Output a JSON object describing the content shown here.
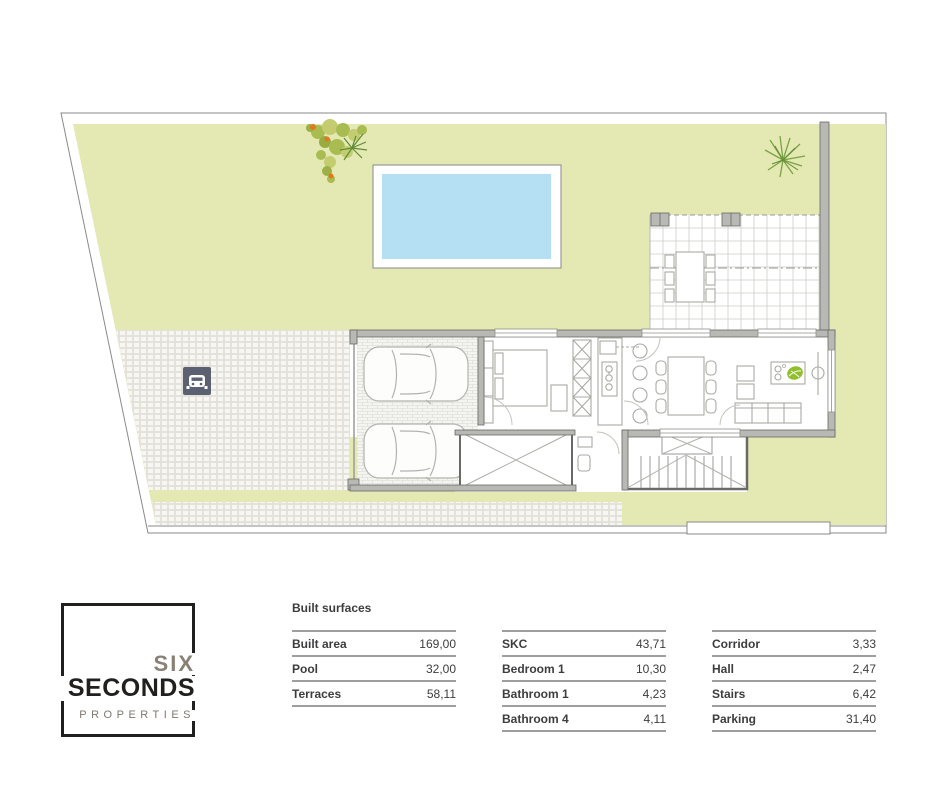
{
  "colors": {
    "garden": "#e4e8b2",
    "pool": "#b5dff2",
    "paving": "#f2f2ef",
    "wall": "#b8b8b4",
    "wall_dark": "#696965",
    "boundary": "#8a8a88",
    "grid": "#cdcdc8",
    "furniture": "#a9a9a4",
    "sign": "#5b6170",
    "island_green": "#8fbf2a",
    "plant": "#a8bc52",
    "plant_alt": "#c3cd6f",
    "plant_dark": "#6f9440",
    "accent_orange": "#e0791f",
    "text": "#3d3d3f",
    "rule": "#9e9e9c",
    "logo_black": "#22201e",
    "logo_gray": "#8a8176",
    "logo_light": "#7d786f"
  },
  "logo": {
    "word_top": "SIX",
    "word_main": "SECONDS",
    "word_sub": "PROPERTIES"
  },
  "surfaces": {
    "heading": "Built surfaces",
    "groups": [
      {
        "rows": [
          {
            "label": "Built area",
            "value": "169,00"
          },
          {
            "label": "Pool",
            "value": "32,00"
          },
          {
            "label": "Terraces",
            "value": "58,11"
          }
        ]
      },
      {
        "rows": [
          {
            "label": "SKC",
            "value": "43,71"
          },
          {
            "label": "Bedroom 1",
            "value": "10,30"
          },
          {
            "label": "Bathroom 1",
            "value": "4,23"
          },
          {
            "label": "Bathroom 4",
            "value": "4,11"
          }
        ]
      },
      {
        "rows": [
          {
            "label": "Corridor",
            "value": "3,33"
          },
          {
            "label": "Hall",
            "value": "2,47"
          },
          {
            "label": "Stairs",
            "value": "6,42"
          },
          {
            "label": "Parking",
            "value": "31,40"
          }
        ]
      }
    ]
  }
}
